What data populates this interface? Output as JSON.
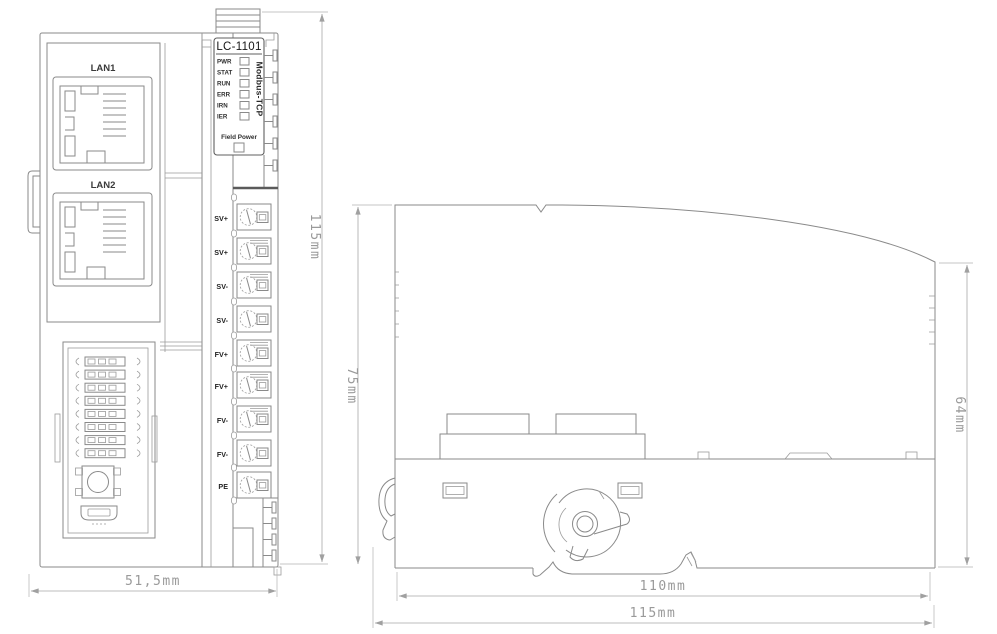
{
  "front": {
    "lan1": "LAN1",
    "lan2": "LAN2",
    "model": "LC-1101",
    "protocol": "Modbus-TCP",
    "leds": [
      "PWR",
      "STAT",
      "RUN",
      "ERR",
      "IRN",
      "IER"
    ],
    "field_power": "Field Power",
    "terminals": [
      "SV+",
      "SV+",
      "SV-",
      "SV-",
      "FV+",
      "FV+",
      "FV-",
      "FV-",
      "PE"
    ]
  },
  "dimensions": {
    "front_height": "115mm",
    "front_width": "51,5mm",
    "side_height": "75mm",
    "side_right_height": "64mm",
    "side_width_inner": "110mm",
    "side_width_outer": "115mm"
  },
  "colors": {
    "line": "#8a8a8a",
    "dim": "#a8a8a8",
    "label": "#2e2e2e"
  }
}
